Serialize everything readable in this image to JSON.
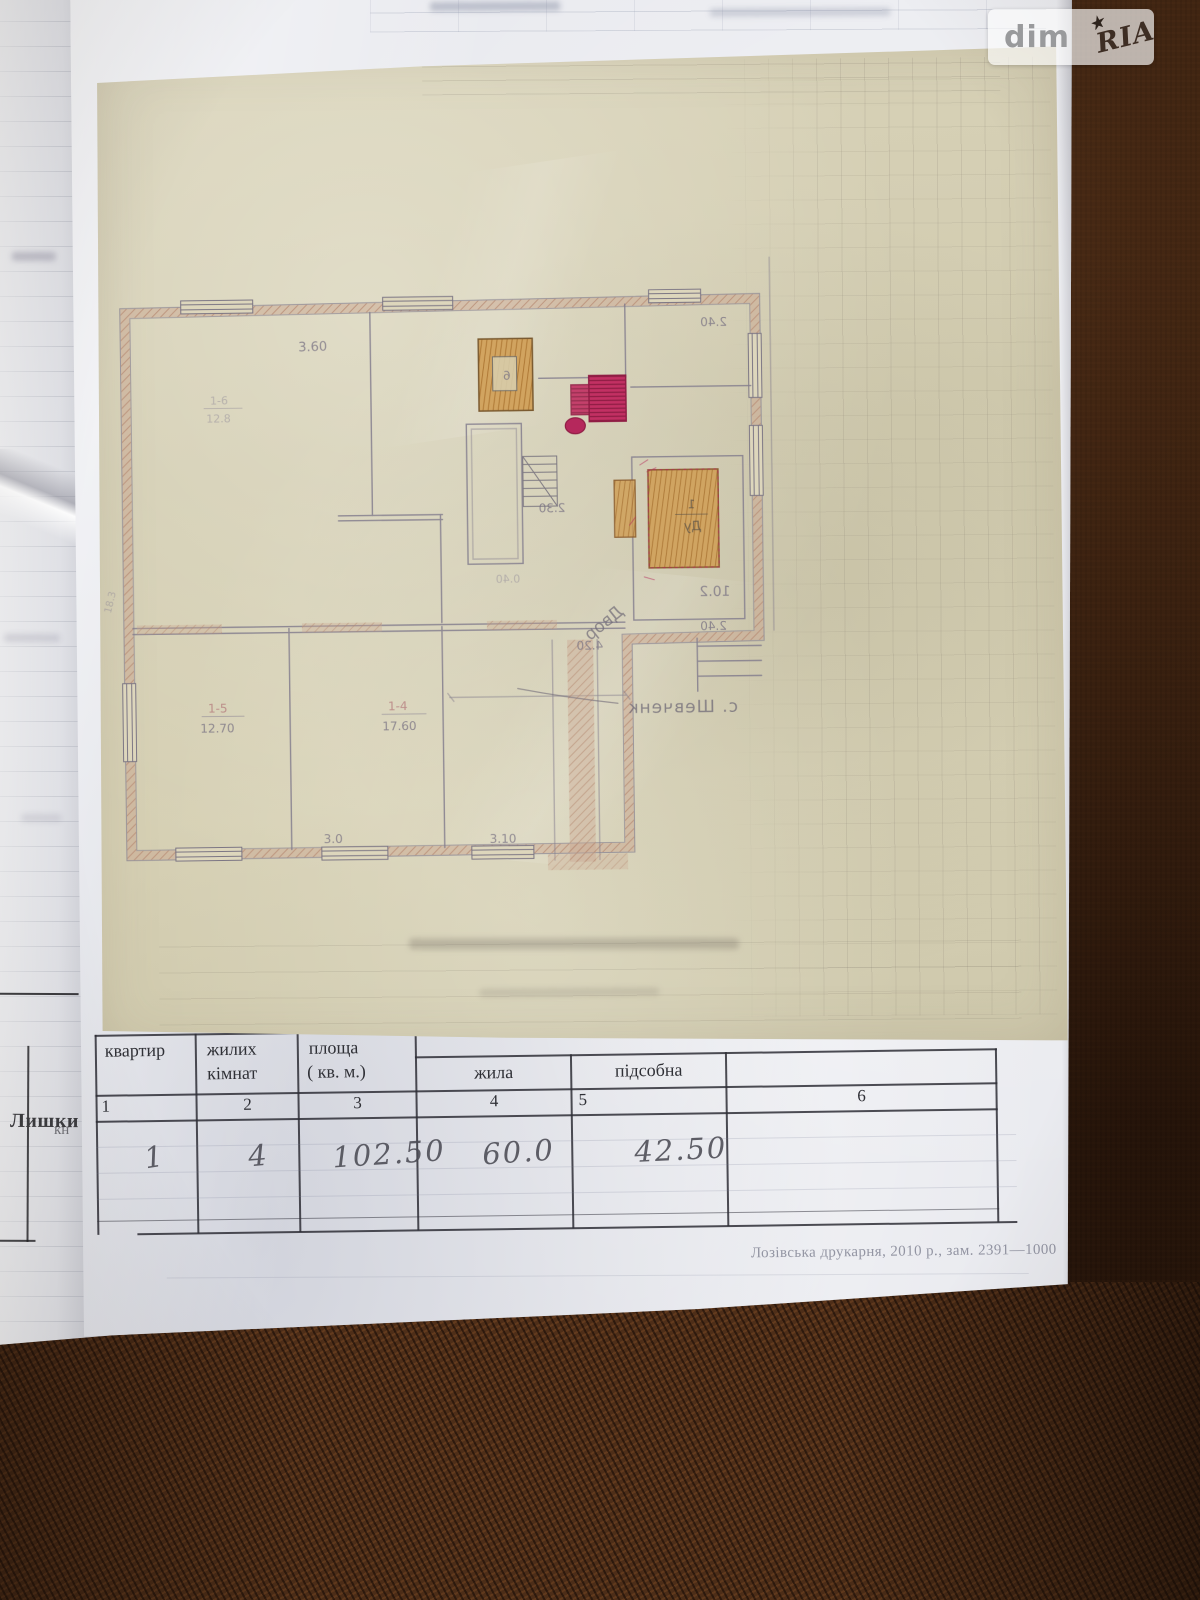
{
  "watermark": {
    "left": "dim",
    "right": "RIA",
    "star": "★"
  },
  "side_page": {
    "word": "Лишки",
    "fragment": "кн"
  },
  "colors": {
    "stove_orange": "#c08a43",
    "stove_crimson": "#b5285c",
    "wall_salmon": "#c49a85",
    "calque_paper": "#d6d0b5",
    "fabric_brown": "#38200f"
  },
  "plan": {
    "rooms": [
      {
        "id": "1-6",
        "area": "12.8"
      },
      {
        "id": "1-5",
        "area": "12.70"
      },
      {
        "id": "1-4",
        "area": "17.60"
      }
    ],
    "dims": {
      "top_left": "3.60",
      "wing_top": "2.40",
      "corridor": "2.30",
      "closet": "0.40",
      "hall": "4.20",
      "wing_area": "10.2",
      "wing_bottom": "2.40",
      "bottom_mid": "3.0",
      "bottom_right": "3.10",
      "left_side": "18.3"
    },
    "notes": {
      "yard": "Двор",
      "village": "с. Шевченк",
      "stove_a_mark": "6",
      "stove_b_top": "1",
      "stove_b_mark": "Ду"
    }
  },
  "table": {
    "headers": {
      "col1": "квартир",
      "col2_line1": "жилих",
      "col2_line2": "кімнат",
      "col3_line1": "площа",
      "col3_line2": "( кв. м.)",
      "col4": "жила",
      "col5": "підсобна"
    },
    "numbers": [
      "1",
      "2",
      "3",
      "4",
      "5",
      "6"
    ],
    "values": {
      "apartments": "1",
      "rooms": "4",
      "total": "102.50",
      "living": "60.0",
      "utility": "42.50"
    }
  },
  "imprint": "Лозівська друкарня, 2010 р., зам. 2391—1000"
}
